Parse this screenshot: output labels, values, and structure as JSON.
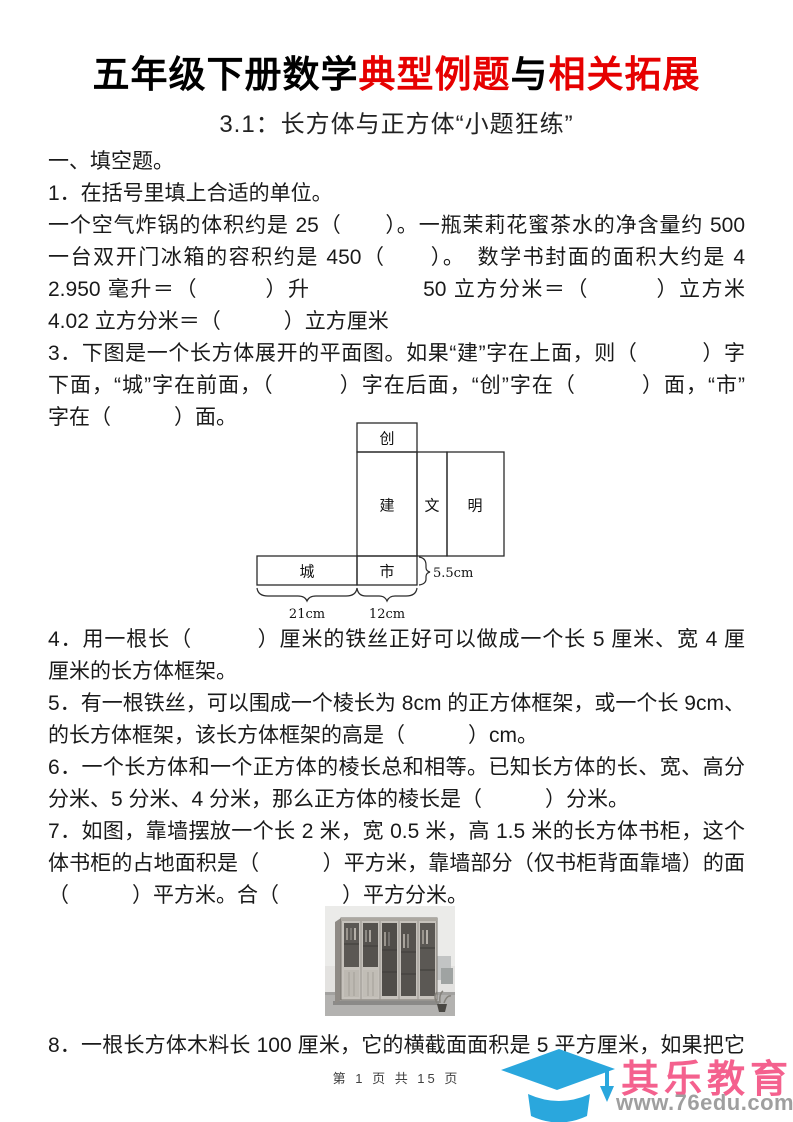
{
  "header": {
    "title": {
      "part1": "五年级下册数学",
      "part2": "典型例题",
      "part3": "与",
      "part4": "相关拓展"
    },
    "subtitle": "3.1：长方体与正方体“小题狂练”"
  },
  "body": {
    "lines": [
      "一、填空题。",
      "1．在括号里填上合适的单位。",
      "一个空气炸锅的体积约是 25（　　）。一瓶茉莉花蜜茶水的净含量约 500（　　）。",
      "一台双开门冰箱的容积约是 450（　　）。　数学书封面的面积大约是 4（　　）。",
      "2.950 毫升＝（　　　）升　　　　　50 立方分米＝（　　　）立方米",
      "4.02 立方分米＝（　　　）立方厘米",
      "3．下图是一个长方体展开的平面图。如果“建”字在上面，则（　　　）字在",
      "下面，“城”字在前面，（　　　）字在后面，“创”字在（　　　）面，“市”",
      "字在（　　　）面。",
      "4．用一根长（　　　）厘米的铁丝正好可以做成一个长 5 厘米、宽 4 厘米、高 6",
      "厘米的长方体框架。",
      "5．有一根铁丝，可以围成一个棱长为 8cm 的正方体框架，或一个长 9cm、宽 7cm",
      "的长方体框架，该长方体框架的高是（　　　）cm。",
      "6．一个长方体和一个正方体的棱长总和相等。已知长方体的长、宽、高分别是 6",
      "分米、5 分米、4 分米，那么正方体的棱长是（　　　）分米。",
      "7．如图，靠墙摆放一个长 2 米，宽 0.5 米，高 1.5 米的长方体书柜，这个长方",
      "体书柜的占地面积是（　　　）平方米，靠墙部分（仅书柜背面靠墙）的面积是",
      "（　　　）平方米。合（　　　）平方分米。",
      "8．一根长方体木料长 100 厘米，它的横截面面积是 5 平方厘米，如果把它截成 3"
    ]
  },
  "net": {
    "faces": {
      "top": "创",
      "front": "建",
      "side_narrow": "文",
      "back": "明",
      "left": "城",
      "bottom": "市"
    },
    "dims": {
      "length": "21cm",
      "width": "12cm",
      "height": "5.5cm"
    }
  },
  "footer": {
    "page_info": "第 1 页 共 15 页"
  },
  "logo": {
    "name": "其乐教育",
    "url": "www.76edu.com"
  },
  "colors": {
    "title_red": "#e60000",
    "logo_blue": "#2aa7dd",
    "logo_pink": "#f4618e",
    "logo_gray": "#9f9f9f"
  }
}
